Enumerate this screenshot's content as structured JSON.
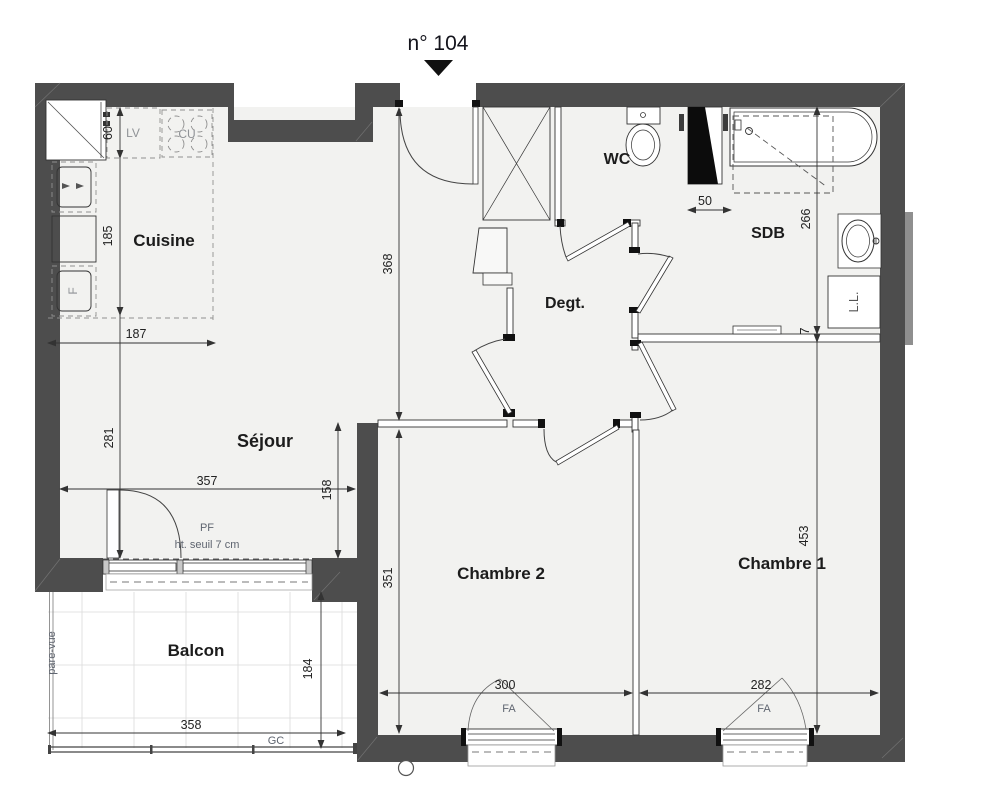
{
  "title": {
    "unit": "n° 104"
  },
  "rooms": {
    "cuisine": "Cuisine",
    "sejour": "Séjour",
    "degt": "Degt.",
    "wc": "WC",
    "sdb": "SDB",
    "chambre2": "Chambre 2",
    "chambre1": "Chambre 1",
    "balcon": "Balcon"
  },
  "fixtures": {
    "lv": "LV",
    "cu": "CU",
    "f": "F",
    "ll": "L.L."
  },
  "annotations": {
    "pf": "PF",
    "pf_seuil": "ht. seuil  7 cm",
    "fa_ch2": "FA",
    "fa_ch1": "FA",
    "gc": "GC",
    "pare_vue": "pare-vue"
  },
  "dims": {
    "d60": "60",
    "d185": "185",
    "d281": "281",
    "d187": "187",
    "d357": "357",
    "d158": "158",
    "d368": "368",
    "d351": "351",
    "d50": "50",
    "d266": "266",
    "d7": "7",
    "d453": "453",
    "d300": "300",
    "d282": "282",
    "d358": "358",
    "d184": "184"
  },
  "colors": {
    "wall": "#4d4d4d",
    "floor": "#f2f2f0",
    "line": "#333333",
    "dim_text": "#222222",
    "label_gray": "#8f9296",
    "ink": "#111111"
  }
}
